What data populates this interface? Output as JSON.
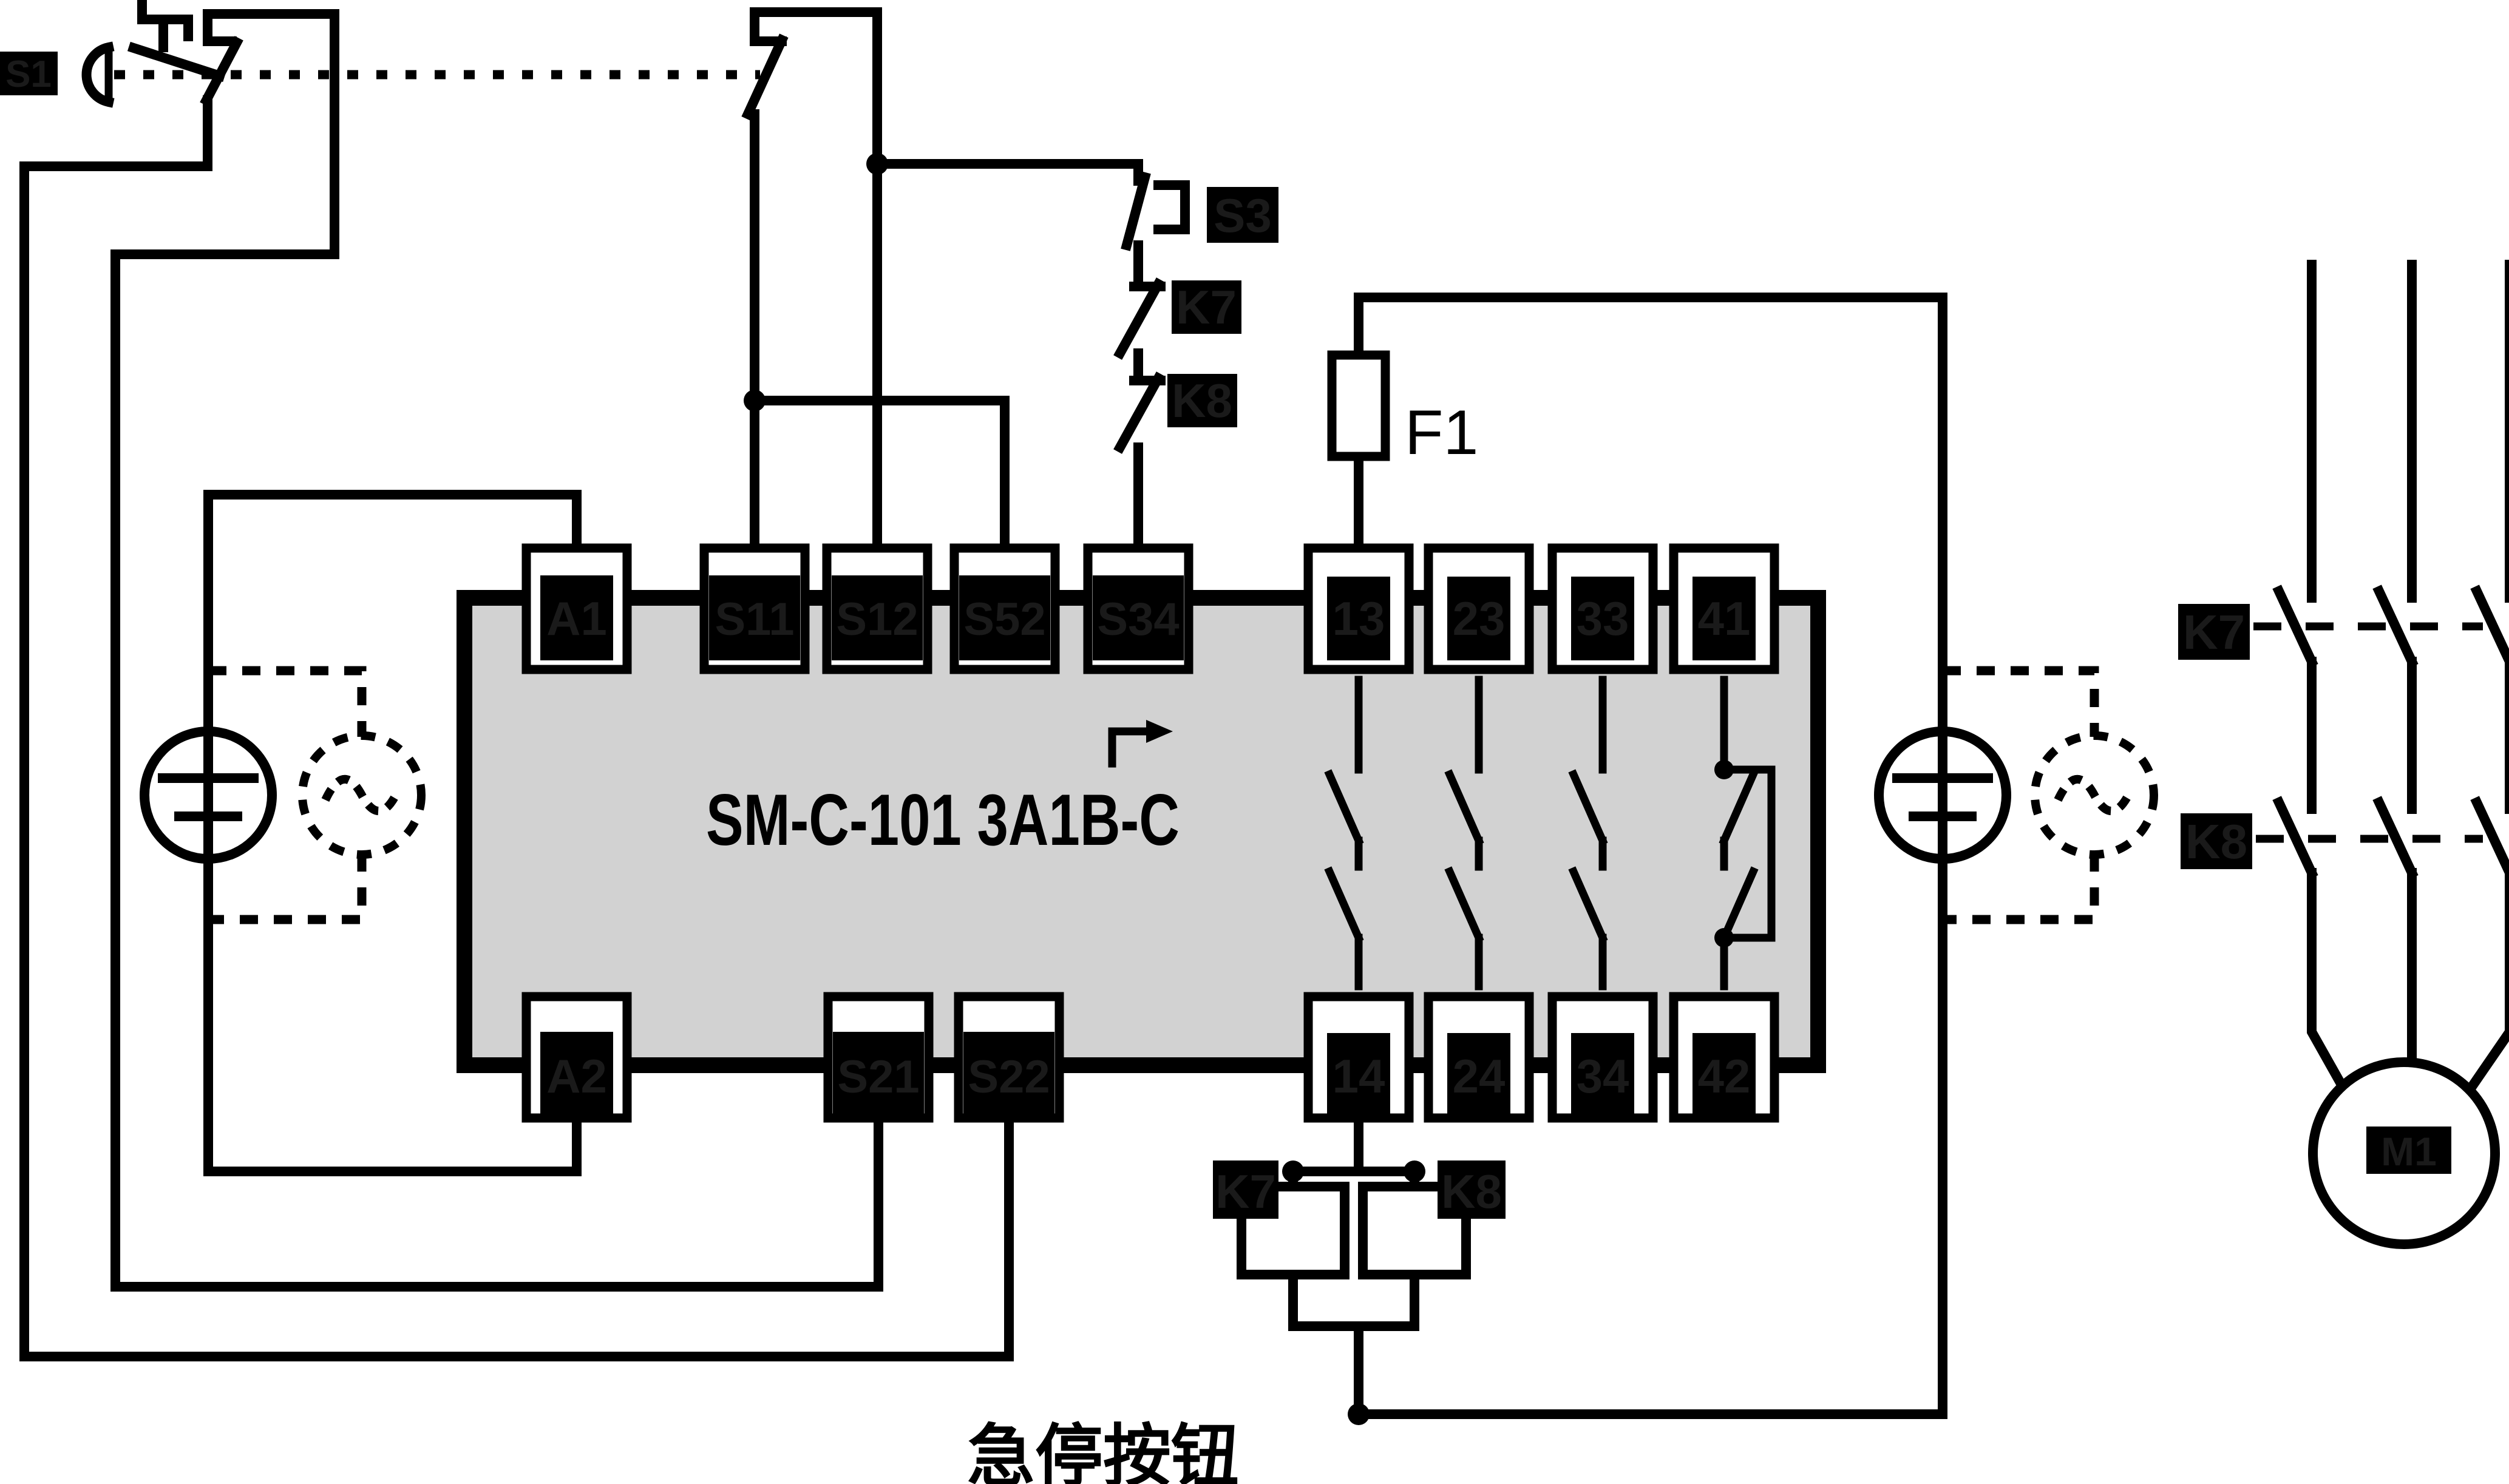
{
  "diagram": {
    "type": "electrical-schematic",
    "module": {
      "label": "SM-C-101 3A1B-C",
      "fill_color": "#d2d2d2"
    },
    "fuse": {
      "label": "F1"
    },
    "caption": {
      "text": "急停按钮"
    },
    "colors": {
      "line": "#000000",
      "background": "#ffffff",
      "module_fill": "#d2d2d2",
      "redaction_fill": "#000000",
      "faint_text": "#1a1a1a"
    },
    "emergency_stop": {
      "redacted_label": "S1"
    },
    "terminals": {
      "top_left": [
        {
          "label": "A1"
        },
        {
          "label": "S11"
        },
        {
          "label": "S12"
        },
        {
          "label": "S52"
        },
        {
          "label": "S34"
        }
      ],
      "top_right": [
        {
          "label": "13"
        },
        {
          "label": "23"
        },
        {
          "label": "33"
        },
        {
          "label": "41"
        }
      ],
      "bottom_left": [
        {
          "label": "A2"
        },
        {
          "label": "S21"
        },
        {
          "label": "S22"
        }
      ],
      "bottom_right": [
        {
          "label": "14"
        },
        {
          "label": "24"
        },
        {
          "label": "34"
        },
        {
          "label": "42"
        }
      ]
    },
    "start_chain": [
      {
        "label": "S3"
      },
      {
        "label": "K7"
      },
      {
        "label": "K8"
      }
    ],
    "coils": [
      {
        "label": "K7"
      },
      {
        "label": "K8"
      }
    ],
    "contactor_rows": [
      {
        "label": "K7"
      },
      {
        "label": "K8"
      }
    ],
    "motor": {
      "redacted_label": "M1"
    }
  }
}
